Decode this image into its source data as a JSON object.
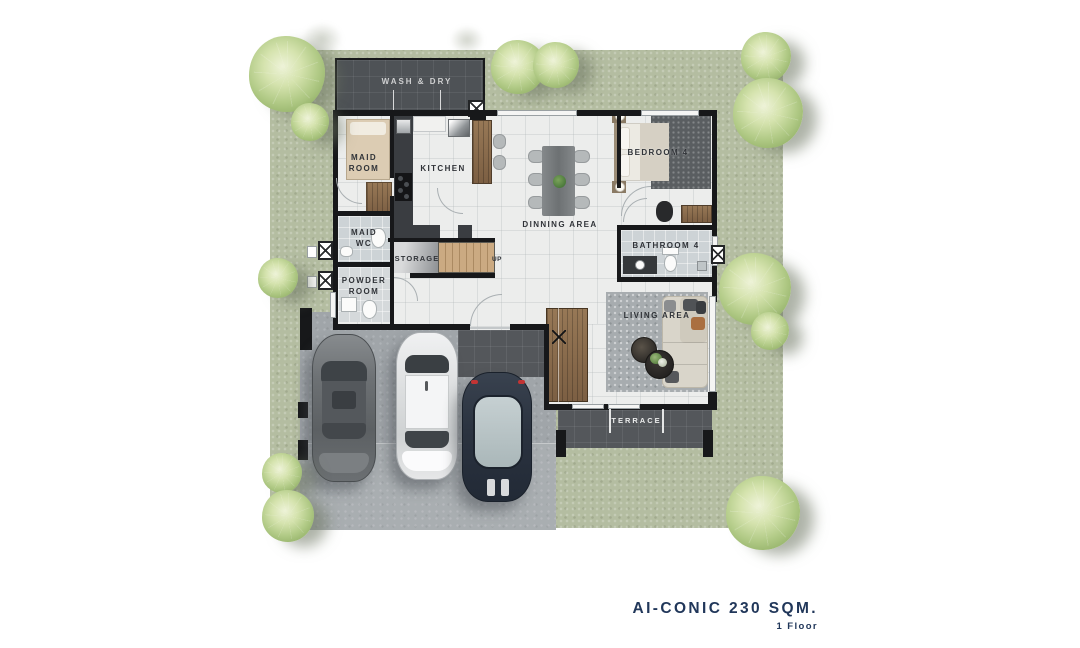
{
  "meta": {
    "kind": "architectural floor plan rendering",
    "canvas": "1080x648"
  },
  "title": {
    "text": "AI-CONIC 230 SQM.",
    "subtitle": "1 Floor",
    "color": "#21375a"
  },
  "labels": {
    "wash_dry": "WASH & DRY",
    "maid_room": {
      "l1": "MAID",
      "l2": "ROOM"
    },
    "kitchen": "KITCHEN",
    "dinning_area": "DINNING AREA",
    "bedroom4": "BEDROOM 4",
    "maid_wc": {
      "l1": "MAID",
      "l2": "WC"
    },
    "storage": "STORAGE",
    "stairs_up": "UP",
    "bathroom4": "BATHROOM 4",
    "powder_room": {
      "l1": "POWDER",
      "l2": "ROOM"
    },
    "living_area": "LIVING AREA",
    "terrace": "TERRACE"
  },
  "palette": {
    "lawn": "#b4bda1",
    "wall": "#17181a",
    "dark_roof": "#4e5256",
    "terrace_tile": "#54575b",
    "driveway": "#a0a5a9",
    "interior_floor": "#ecedec",
    "wet_floor": "#cdd3d6",
    "wood": "#8a6c4d",
    "tree": "#a9c47f",
    "title_navy": "#21375a"
  },
  "objects": {
    "cars": [
      "graphite sedan",
      "white suv",
      "navy hatchback"
    ],
    "tree_count": 12
  }
}
